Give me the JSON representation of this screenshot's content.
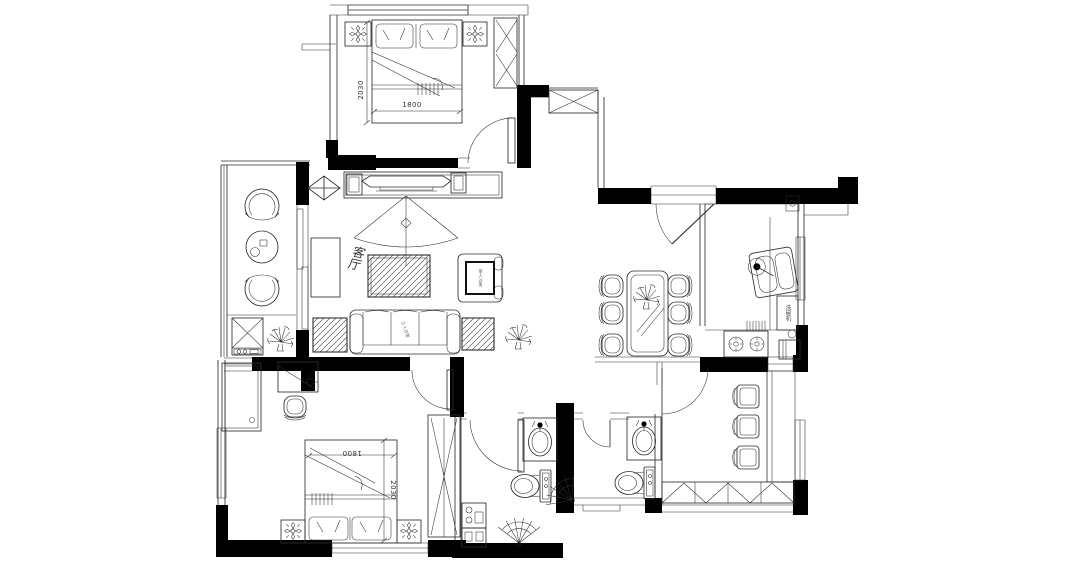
{
  "colors": {
    "line": "#2e2e2e",
    "wall": "#000000",
    "background": "#ffffff"
  },
  "labels": {
    "living_room": "客厅",
    "sofa": "三人沙发",
    "armchair": "单人沙发",
    "kitchen_appliance": "洗碗机"
  },
  "dimensions": {
    "master_bed": {
      "width": "1800",
      "length": "2030"
    },
    "second_bed": {
      "width": "1800",
      "length": "2030"
    }
  }
}
